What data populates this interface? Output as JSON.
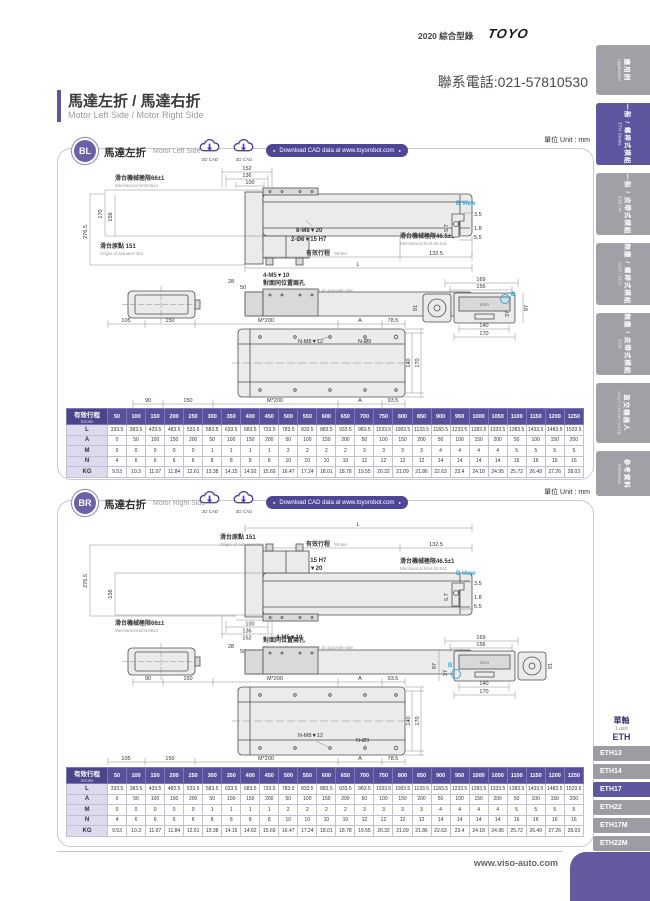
{
  "header": {
    "catalog": "2020 綜合型錄",
    "brand": "TOYO",
    "phone": "聯系電話:021-57810530"
  },
  "title": {
    "zh": "馬達左折 / 馬達右折",
    "en": "Motor Left Side / Motor Right Side"
  },
  "unit": "單位 Unit : mm",
  "cad": {
    "d2": "2D CAD",
    "d3": "3D CAD",
    "download": "Download CAD data at www.toyorobot.com"
  },
  "sections": {
    "bl": {
      "badge": "BL",
      "zh": "馬達左折",
      "en": "Motor Left Side"
    },
    "br": {
      "badge": "BR",
      "zh": "馬達右折",
      "en": "Motor Right Side"
    }
  },
  "dims": {
    "mech66_zh": "滑台機械極限66±1",
    "mech66_en": "Mechanical limit:66±1",
    "mech465_zh": "滑台機械極限46.5±1",
    "mech465_en": "Mechanical limit:46.5±1",
    "origin_zh": "滑台原點 151",
    "origin_en": "Origin of actuator:151",
    "stroke_zh": "有效行程",
    "stroke_en": "Stroke",
    "holes8": "8-M8▼20",
    "holes2": "2-Ø6▼15 H7",
    "holes4": "4-M5▼10",
    "opp_zh": "對面同位置兩孔",
    "opp_en": "2 holes on the same position at opposite side.",
    "nm8": "N-M8▼12",
    "nd9": "N-Ø9",
    "m200": "M*200",
    "A": "A",
    "L": "L",
    "bview": "B View",
    "b": "B",
    "toyo": "TOYO",
    "d152": "152",
    "d136": "136",
    "d100": "100",
    "d276": "276.5",
    "d170": "170",
    "d156": "156",
    "d132": "132.5",
    "d28": "28",
    "d50": "50",
    "d105": "105",
    "d150": "150",
    "d78": "78.5",
    "d90": "90",
    "d93": "93.5",
    "d140": "140",
    "d169": "169",
    "d91": "91",
    "d97": "97",
    "d37": "37",
    "d35": "3.5",
    "d57": "5.7",
    "d18": "1.8",
    "d55": "5.5"
  },
  "table": {
    "header_zh": "有效行程",
    "header_en": "Stroke",
    "strokes": [
      "50",
      "100",
      "150",
      "200",
      "250",
      "300",
      "350",
      "400",
      "450",
      "500",
      "550",
      "600",
      "650",
      "700",
      "750",
      "800",
      "850",
      "900",
      "950",
      "1000",
      "1050",
      "1100",
      "1150",
      "1200",
      "1250"
    ],
    "rows": [
      {
        "label": "L",
        "values": [
          "333.5",
          "383.5",
          "433.5",
          "483.5",
          "533.5",
          "583.5",
          "633.5",
          "683.5",
          "733.5",
          "783.5",
          "833.5",
          "883.5",
          "933.5",
          "983.5",
          "1033.5",
          "1083.5",
          "1133.5",
          "1183.5",
          "1233.5",
          "1283.5",
          "1333.5",
          "1383.5",
          "1433.5",
          "1483.5",
          "1533.5"
        ]
      },
      {
        "label": "A",
        "values": [
          "0",
          "50",
          "100",
          "150",
          "200",
          "50",
          "100",
          "150",
          "200",
          "50",
          "100",
          "150",
          "200",
          "50",
          "100",
          "150",
          "200",
          "50",
          "100",
          "150",
          "200",
          "50",
          "100",
          "150",
          "200"
        ]
      },
      {
        "label": "M",
        "values": [
          "0",
          "0",
          "0",
          "0",
          "0",
          "1",
          "1",
          "1",
          "1",
          "2",
          "2",
          "2",
          "2",
          "3",
          "3",
          "3",
          "3",
          "4",
          "4",
          "4",
          "4",
          "5",
          "5",
          "5",
          "5"
        ]
      },
      {
        "label": "N",
        "values": [
          "4",
          "6",
          "6",
          "6",
          "6",
          "8",
          "8",
          "8",
          "8",
          "10",
          "10",
          "10",
          "10",
          "12",
          "12",
          "12",
          "12",
          "14",
          "14",
          "14",
          "14",
          "16",
          "16",
          "16",
          "16"
        ]
      },
      {
        "label": "KG",
        "values": [
          "9.53",
          "10.3",
          "11.07",
          "11.84",
          "12.61",
          "13.38",
          "14.15",
          "14.92",
          "15.69",
          "16.47",
          "17.24",
          "18.01",
          "18.78",
          "19.55",
          "20.32",
          "21.09",
          "21.86",
          "22.63",
          "23.4",
          "24.18",
          "24.95",
          "25.72",
          "26.49",
          "27.26",
          "28.03"
        ]
      }
    ]
  },
  "sidebar": {
    "tabs": [
      {
        "zh": "應用例",
        "en": "Application",
        "active": false
      },
      {
        "zh": "一般 / 螺桿式模組",
        "en": "ETH Series",
        "active": true
      },
      {
        "zh": "一般 / 皮帶式模組",
        "en": "ETB / M",
        "active": false
      },
      {
        "zh": "無塵 / 螺桿式模組",
        "en": "GCH / ECH",
        "active": false
      },
      {
        "zh": "無塵 / 皮帶式模組",
        "en": "ECB",
        "active": false
      },
      {
        "zh": "直交機器人",
        "en": "XYGT / XYTH / XYTB",
        "active": false
      },
      {
        "zh": "參考資料",
        "en": "Reference",
        "active": false
      }
    ]
  },
  "axis_nav": {
    "zh": "單軸",
    "en": "1 axis",
    "series": "ETH",
    "models": [
      {
        "label": "ETH13",
        "active": false
      },
      {
        "label": "ETH14",
        "active": false
      },
      {
        "label": "ETH17",
        "active": true
      },
      {
        "label": "ETH22",
        "active": false
      },
      {
        "label": "ETH17M",
        "active": false
      },
      {
        "label": "ETH22M",
        "active": false
      }
    ]
  },
  "footer": {
    "url": "www.viso-auto.com"
  }
}
